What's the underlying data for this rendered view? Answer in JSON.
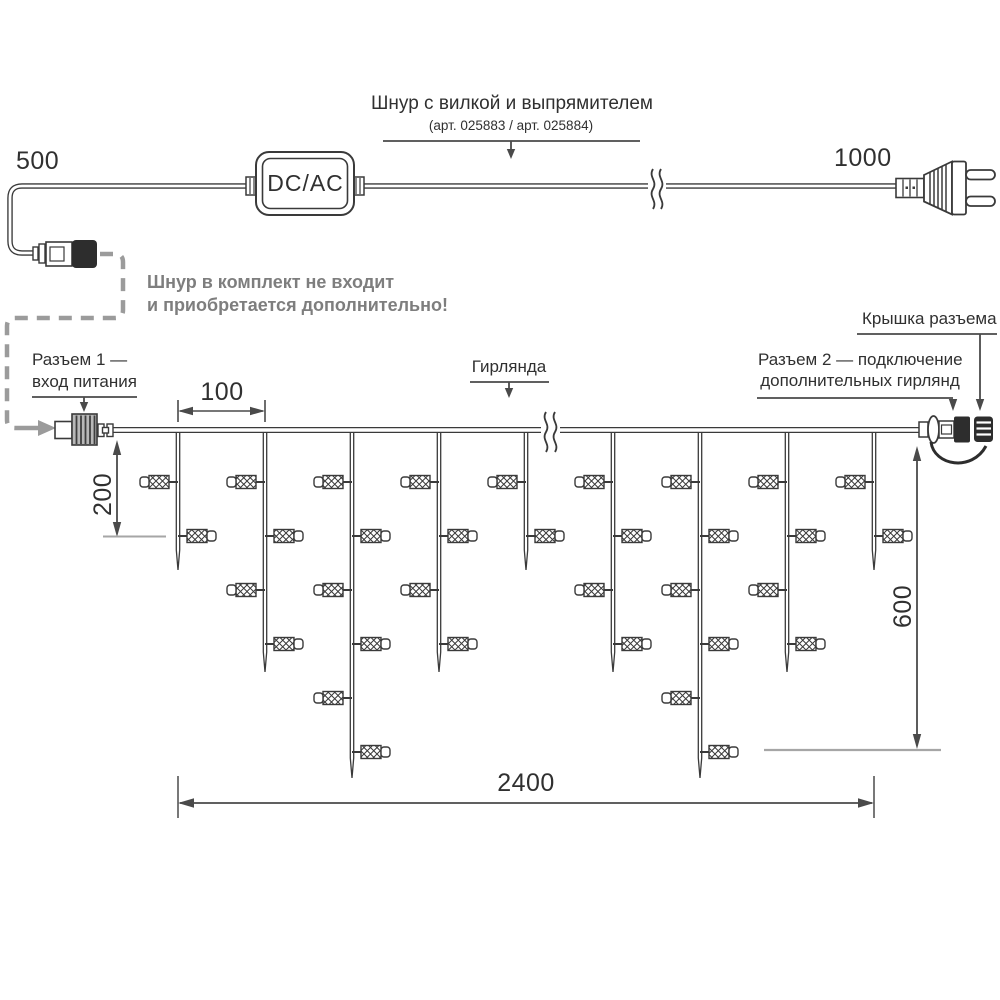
{
  "converter_label": "DC/AC",
  "cord": {
    "label": "Шнур с вилкой и выпрямителем",
    "sublabel": "(арт. 025883 / арт. 025884)",
    "left_length": "500",
    "right_length": "1000"
  },
  "note": {
    "line1": "Шнур в комплект не входит",
    "line2": "и приобретается дополнительно!"
  },
  "connector1": {
    "line1": "Разъем 1 —",
    "line2": "вход питания"
  },
  "connector2": {
    "line1": "Разъем 2 — подключение",
    "line2": "дополнительных гирлянд"
  },
  "cap_label": "Крышка разъема",
  "garland_label": "Гирлянда",
  "dims": {
    "spacing": "100",
    "min_drop": "200",
    "max_drop": "600",
    "total": "2400"
  },
  "garland": {
    "wire_y": 430,
    "led_first_y": 482,
    "led_spacing": 54,
    "drops": [
      {
        "x": 178,
        "leds": 2,
        "tip_y": 570
      },
      {
        "x": 265,
        "leds": 4,
        "tip_y": 672
      },
      {
        "x": 352,
        "leds": 6,
        "tip_y": 778
      },
      {
        "x": 439,
        "leds": 4,
        "tip_y": 672
      },
      {
        "x": 526,
        "leds": 2,
        "tip_y": 570
      },
      {
        "x": 613,
        "leds": 4,
        "tip_y": 672
      },
      {
        "x": 700,
        "leds": 6,
        "tip_y": 778
      },
      {
        "x": 787,
        "leds": 4,
        "tip_y": 672
      },
      {
        "x": 874,
        "leds": 2,
        "tip_y": 570
      }
    ]
  },
  "colors": {
    "ink": "#3a3a3a",
    "dim_lines": "#4a4a4a",
    "muted_text": "#7e7e7e",
    "dashed_guide": "#9b9b9b",
    "reference_line": "#a6a6a6",
    "dark_fill": "#2d2d2d",
    "background": "#ffffff"
  }
}
